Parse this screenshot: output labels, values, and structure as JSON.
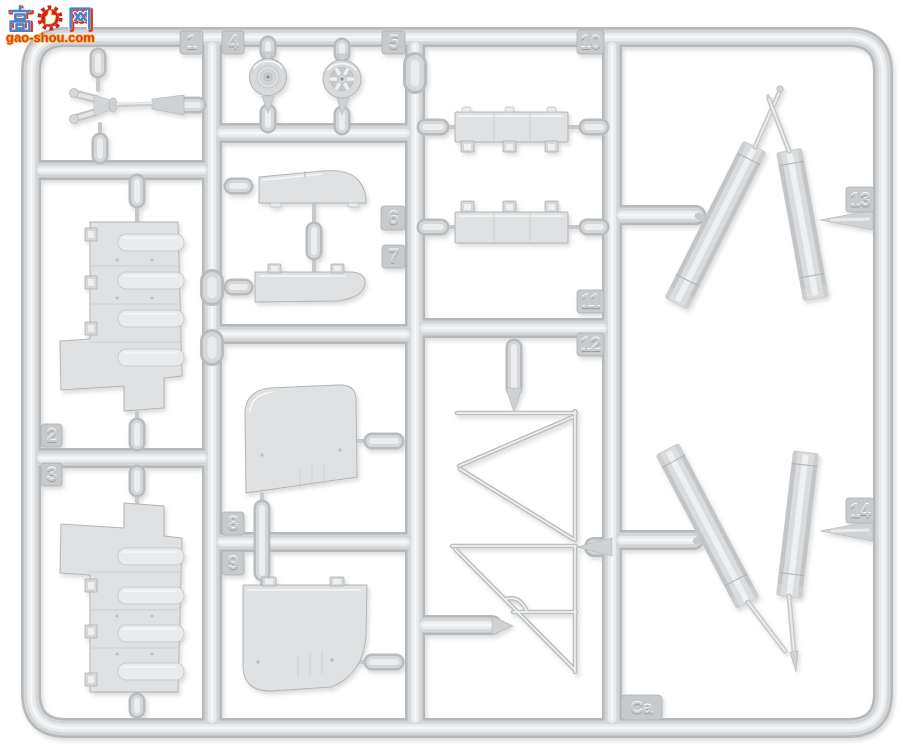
{
  "watermark": {
    "char_left": "高",
    "char_right": "网",
    "domain": "gao-shou.com"
  },
  "sprue": {
    "material": "light-gray styrene",
    "tags": [
      {
        "id": "1",
        "label": "1"
      },
      {
        "id": "2",
        "label": "2"
      },
      {
        "id": "3",
        "label": "3"
      },
      {
        "id": "4",
        "label": "4"
      },
      {
        "id": "5",
        "label": "5"
      },
      {
        "id": "6",
        "label": "6"
      },
      {
        "id": "7",
        "label": "7"
      },
      {
        "id": "8",
        "label": "8"
      },
      {
        "id": "9",
        "label": "9"
      },
      {
        "id": "10",
        "label": "10"
      },
      {
        "id": "11",
        "label": "11"
      },
      {
        "id": "12",
        "label": "12"
      },
      {
        "id": "13",
        "label": "13"
      },
      {
        "id": "14",
        "label": "14"
      },
      {
        "id": "Ca",
        "label": "Ca"
      }
    ]
  },
  "colors": {
    "background": "#ffffff",
    "runner_edge": "#b6b9bb",
    "runner_mid": "#d3d5d7",
    "runner_highlight": "#f5f6f7",
    "part_fill": "#dfe1e3",
    "part_edge": "#b2b5b7",
    "tag_fill": "#c7cacc",
    "watermark_blue": "#4f7fc4",
    "watermark_red": "#d53a22",
    "watermark_domain_red": "#e5391d",
    "watermark_outline_gold": "#f2c04a"
  }
}
